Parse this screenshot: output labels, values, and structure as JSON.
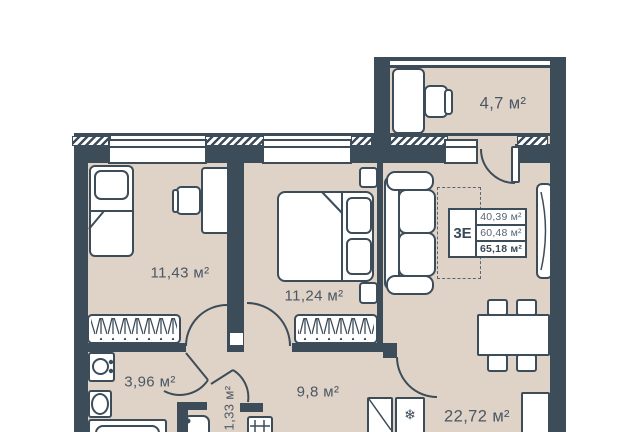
{
  "unit_panel": {
    "unit_label": "3Е",
    "area_rows": [
      "40,39 м²",
      "60,48 м²",
      "65,18 м²"
    ]
  },
  "room_labels": {
    "balcony": "4,7 м²",
    "bedroom_1": "11,43 м²",
    "bedroom_2": "11,24 м²",
    "bathroom": "3,96 м²",
    "wc": "1,33 м²",
    "hallway": "9,8 м²",
    "kitchen_living": "22,72 м²"
  },
  "icons": {
    "fridge_snowflake": "❄"
  },
  "colors": {
    "wall": "#3C4C59",
    "floor": "#DFD2C6",
    "label_text": "#4A5764"
  }
}
